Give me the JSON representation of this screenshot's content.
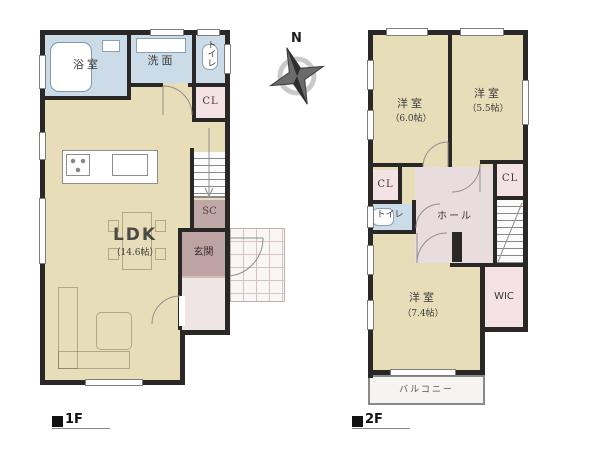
{
  "compass": {
    "north_label": "N"
  },
  "floor1": {
    "marker": "■",
    "label": "1F",
    "rooms": {
      "bath": {
        "label": "浴室"
      },
      "washroom": {
        "label": "洗面"
      },
      "toilet": {
        "label": "トイレ"
      },
      "closet": {
        "label": "CL"
      },
      "ldk": {
        "label": "LDK",
        "size": "（14.6帖）"
      },
      "shoe_closet": {
        "label": "SC"
      },
      "entrance": {
        "label": "玄関"
      }
    }
  },
  "floor2": {
    "marker": "■",
    "label": "2F",
    "rooms": {
      "bedroom_a": {
        "label": "洋室",
        "size": "（6.0帖）"
      },
      "bedroom_b": {
        "label": "洋室",
        "size": "（5.5帖）"
      },
      "closet_a": {
        "label": "CL"
      },
      "closet_b": {
        "label": "CL"
      },
      "toilet": {
        "label": "トイレ"
      },
      "hall": {
        "label": "ホール"
      },
      "bedroom_c": {
        "label": "洋室",
        "size": "（7.4帖）"
      },
      "wic": {
        "label": "WIC"
      },
      "balcony": {
        "label": "バルコニー"
      }
    }
  },
  "colors": {
    "room_beige": "#e7ddb8",
    "water_blue": "#cbdbe7",
    "closet_pink": "#f4e2e5",
    "entrance_mauve": "#bda3a1",
    "shoe_closet_mauve": "#c0a8a6",
    "hall_pink": "#e9dcdf",
    "wall_dark": "#2a2727"
  }
}
